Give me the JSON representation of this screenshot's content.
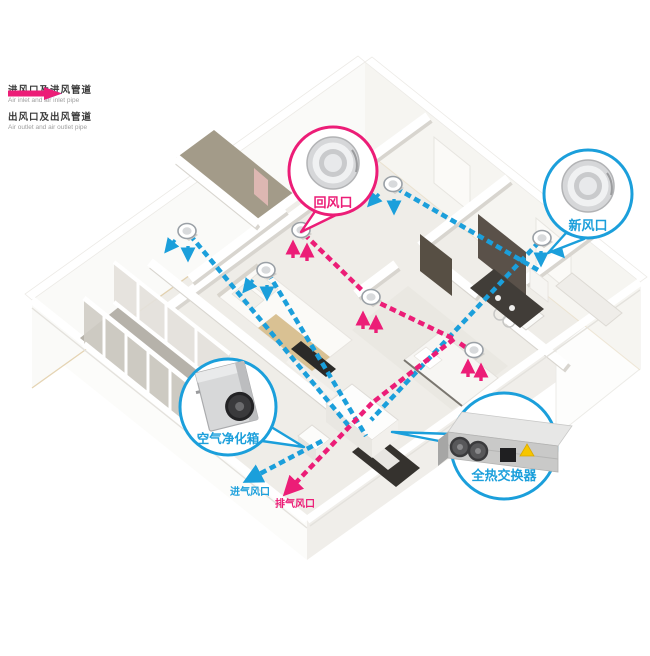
{
  "legend": {
    "inlet": {
      "zh": "进风口及进风管道",
      "en": "Air inlet and air inlet pipe",
      "color": "#1b9fdb"
    },
    "outlet": {
      "zh": "出风口及出风管道",
      "en": "Air outlet and air outlet pipe",
      "color": "#ec1d77"
    }
  },
  "callouts": {
    "return_air": {
      "label": "回风口",
      "color": "#ec1d77"
    },
    "fresh_air": {
      "label": "新风口",
      "color": "#1b9fdb"
    },
    "purifier": {
      "label": "空气净化箱",
      "color": "#1b9fdb"
    },
    "heat_exchanger": {
      "label": "全热交换器",
      "color": "#1b9fdb"
    }
  },
  "pipe_labels": {
    "intake": {
      "label": "进气风口",
      "color": "#1b9fdb"
    },
    "exhaust": {
      "label": "排气风口",
      "color": "#ec1d77"
    }
  }
}
